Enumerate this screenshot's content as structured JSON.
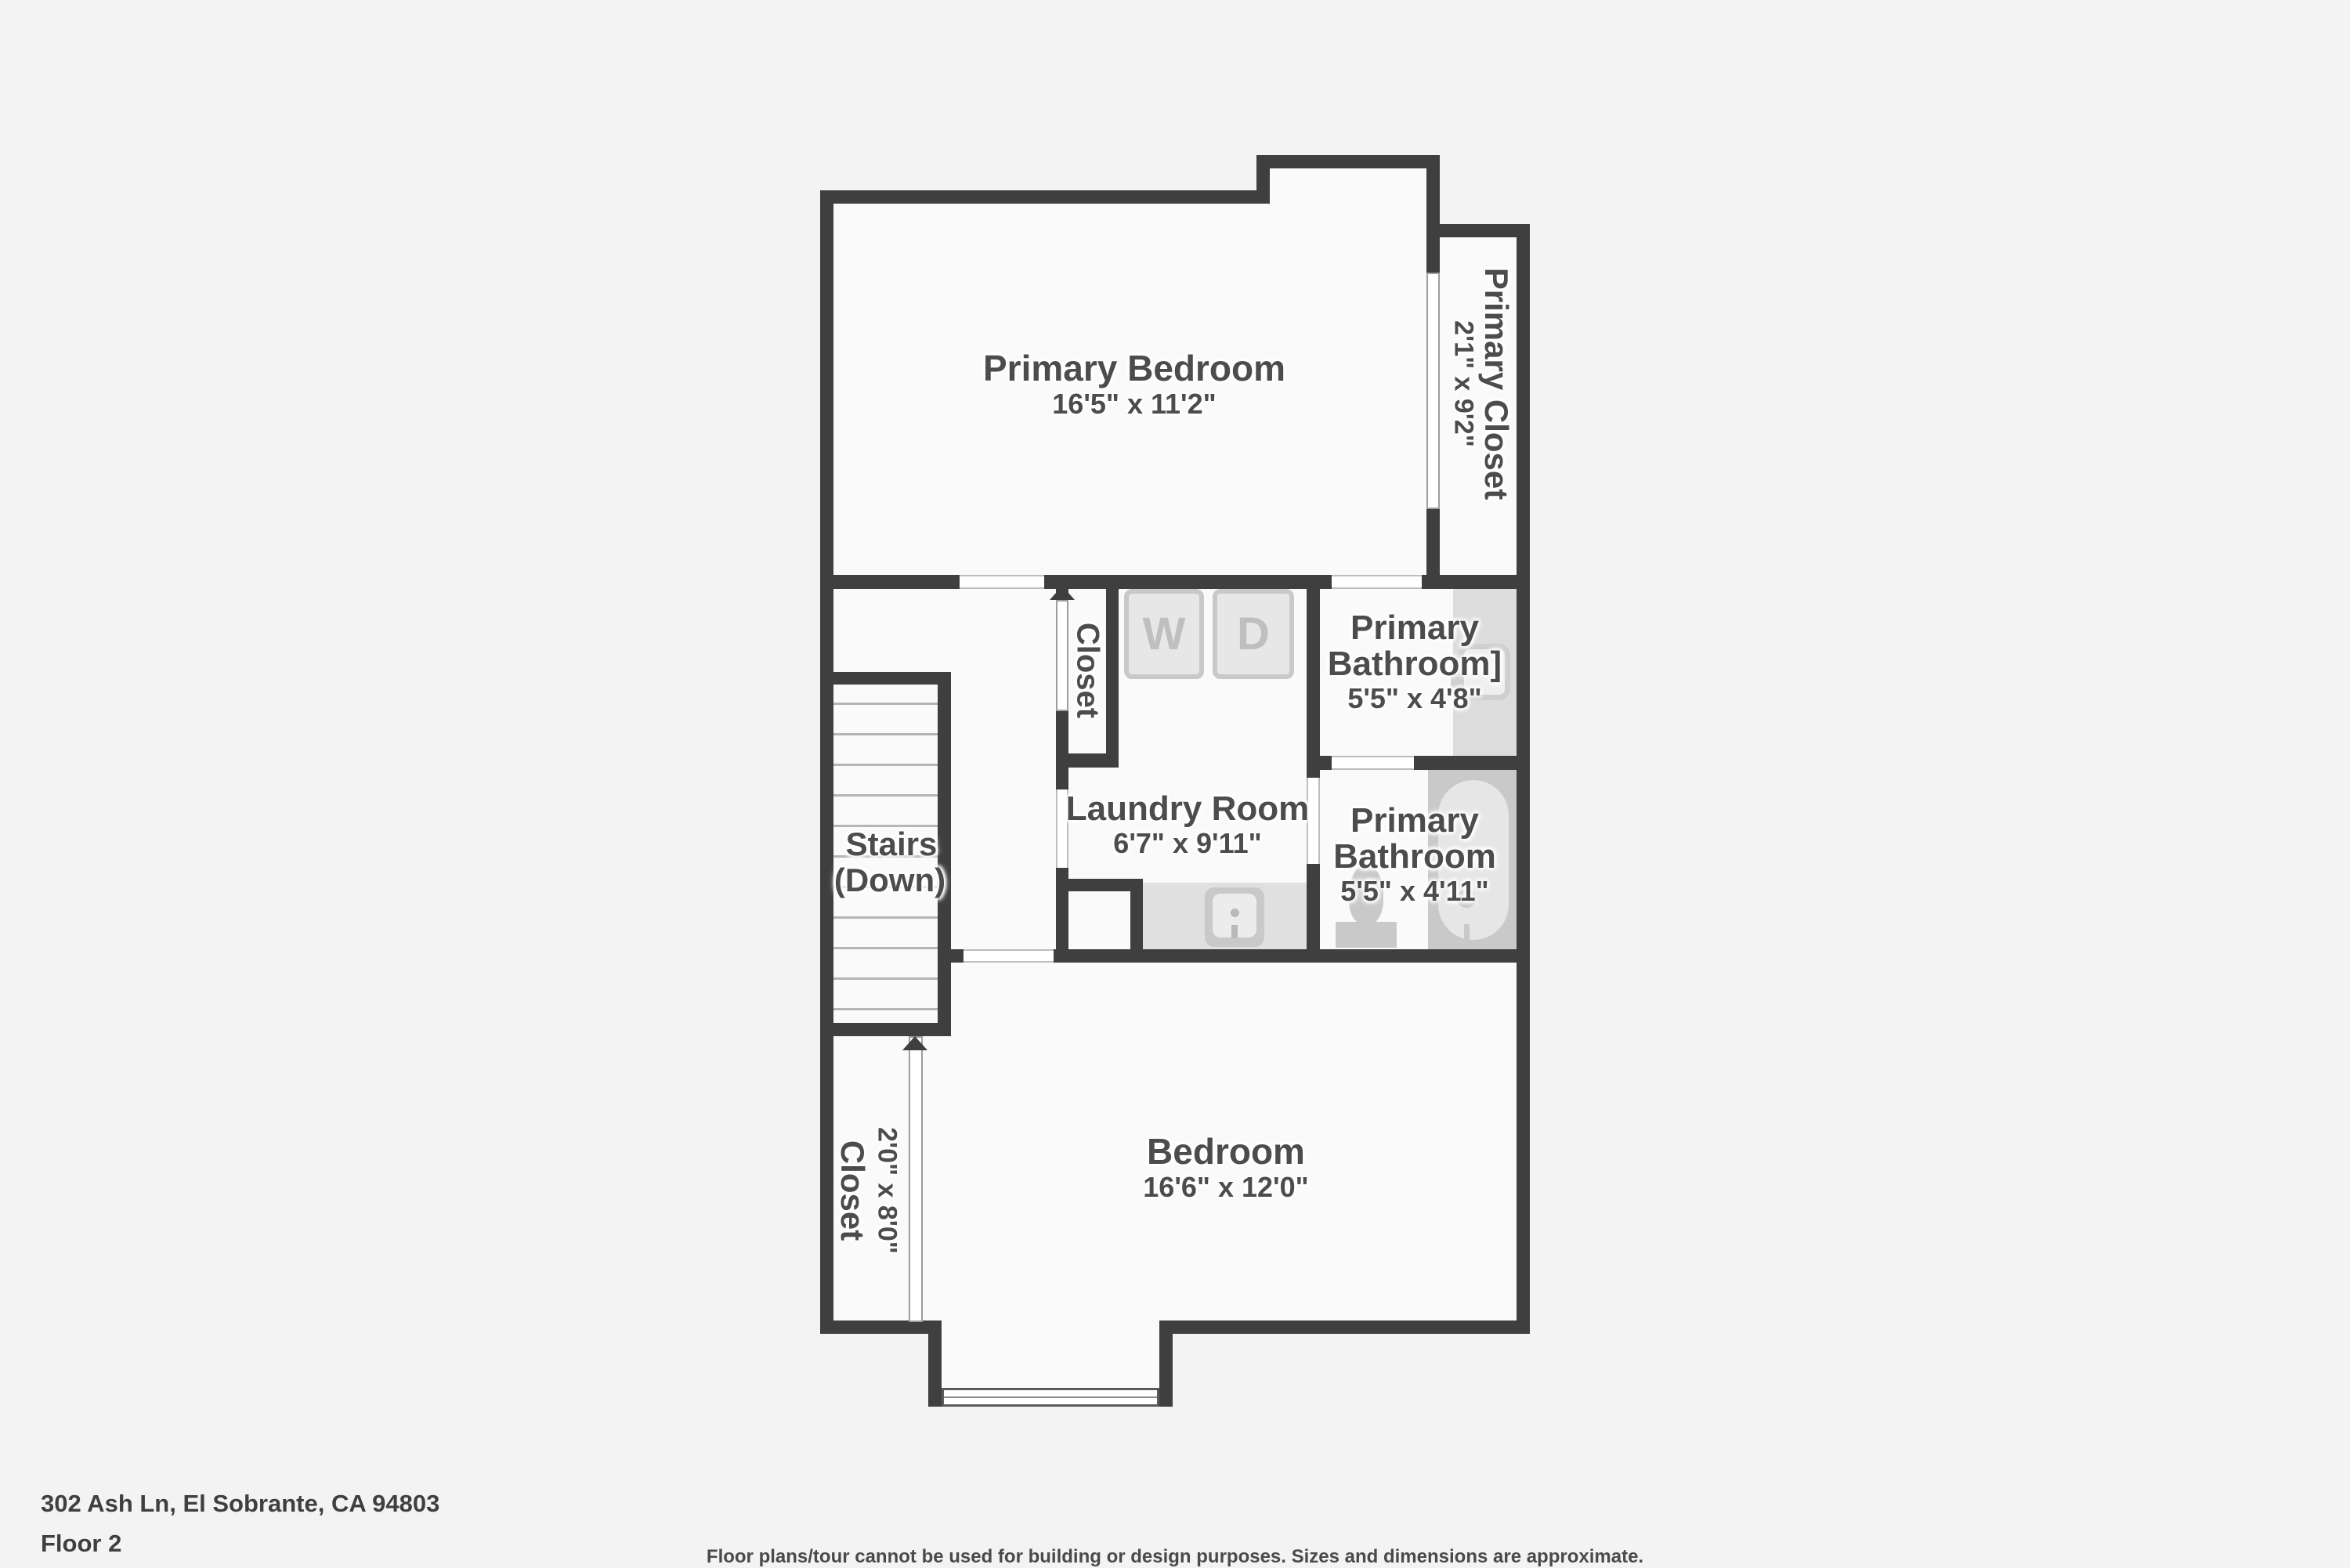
{
  "meta": {
    "domain": "floor-plan-viewer",
    "colors": {
      "background": "#f3f3f3",
      "floor": "#fafafa",
      "wall": "#3f3f3f",
      "label_text": "#4c4c4c",
      "fixture_gray": "#c9c9c9",
      "appliance_letter": "#bfbfbf"
    }
  },
  "rooms": {
    "primary_bedroom": {
      "name": "Primary Bedroom",
      "dims": "16'5\" x 11'2\""
    },
    "primary_closet": {
      "name": "Primary Closet",
      "dims": "2'1\" x 9'2\""
    },
    "closet_mid": {
      "name": "Closet"
    },
    "laundry": {
      "name": "Laundry Room",
      "dims": "6'7\" x 9'11\""
    },
    "bath_upper": {
      "name_line1": "Primary",
      "name_line2": "Bathroom]",
      "dims": "5'5\" x 4'8\""
    },
    "bath_lower": {
      "name_line1": "Primary",
      "name_line2": "Bathroom",
      "dims": "5'5\" x 4'11\""
    },
    "stairs": {
      "line1": "Stairs",
      "line2": "(Down)"
    },
    "bedroom": {
      "name": "Bedroom",
      "dims": "16'6\" x 12'0\""
    },
    "closet_left": {
      "name": "Closet",
      "dims": "2'0\" x 8'0\""
    }
  },
  "appliances": {
    "washer": "W",
    "dryer": "D"
  },
  "footer": {
    "address": "302 Ash Ln, El Sobrante, CA 94803",
    "floor_label": "Floor 2",
    "disclaimer": "Floor plans/tour cannot be used for building or design purposes. Sizes and dimensions are approximate."
  }
}
